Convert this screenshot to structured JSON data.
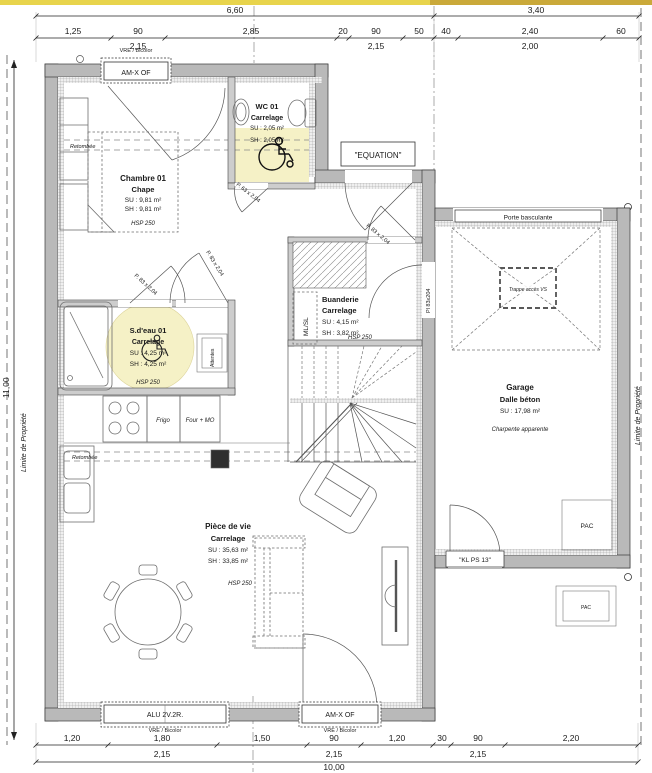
{
  "colors": {
    "highlight": "#f5f1c6",
    "walls": "#b9b9b9",
    "titlebar_left": "#e8d44c",
    "titlebar_right": "#caa93a"
  },
  "dims": {
    "top1": [
      "6,60",
      "3,40"
    ],
    "top2": [
      "1,25",
      "90",
      "2,85",
      "20",
      "90",
      "50",
      "40",
      "2,40",
      "60"
    ],
    "top3": [
      "2,15",
      "2,15",
      "2,00"
    ],
    "bot1": [
      "1,20",
      "1,80",
      "1,50",
      "90",
      "1,20",
      "30",
      "90",
      "2,20"
    ],
    "bot2": [
      "2,15",
      "2,15",
      "2,15"
    ],
    "bot_total": "10,00",
    "left_total": "11,00"
  },
  "rooms": {
    "chambre": {
      "name": "Chambre 01",
      "floor": "Chape",
      "su": "SU : 9,81 m²",
      "sh": "SH : 9,81 m²",
      "hsp": "HSP 250"
    },
    "wc": {
      "name": "WC 01",
      "floor": "Carrelage",
      "su": "SU : 2,05 m²",
      "sh": "SH : 2,05 m²"
    },
    "sdeau": {
      "name": "S.d'eau 01",
      "floor": "Carrelage",
      "su": "SU : 4,25 m²",
      "sh": "SH : 4,25 m²",
      "hsp": "HSP 250"
    },
    "buanderie": {
      "name": "Buanderie",
      "floor": "Carrelage",
      "su": "SU : 4,15 m²",
      "sh": "SH : 3,82 m²",
      "hsp": "HSP 250"
    },
    "piece": {
      "name": "Pièce de vie",
      "floor": "Carrelage",
      "su": "SU : 35,63 m²",
      "sh": "SH : 33,85 m²",
      "hsp": "HSP 250"
    },
    "garage": {
      "name": "Garage",
      "floor": "Dalle béton",
      "su": "SU : 17,98 m²",
      "note": "Charpente apparente"
    }
  },
  "openings": {
    "entrance": "\"EQUATION\"",
    "porte_basculante": "Porte basculante",
    "kl_ps13": "\"KL PS 13\"",
    "window_top": "AM-X OF",
    "window_alu": "ALU 2V.2R.",
    "window_amx_bottom": "AM-X OF",
    "vre": "VRE / Bicolor",
    "door_p63": "P. 63 x 2,04",
    "door_p83": "P. 83 x 2,04",
    "door_pl83": "Pl 83x204"
  },
  "annot": {
    "retombee": "Retombée",
    "ml_sl": "ML/SL",
    "attentes": "Attentes",
    "trappe": "Trappe accès VS",
    "frigo": "Frigo",
    "four_mo": "Four + MO",
    "pac": "PAC",
    "limite": "Limite de Propriété"
  }
}
